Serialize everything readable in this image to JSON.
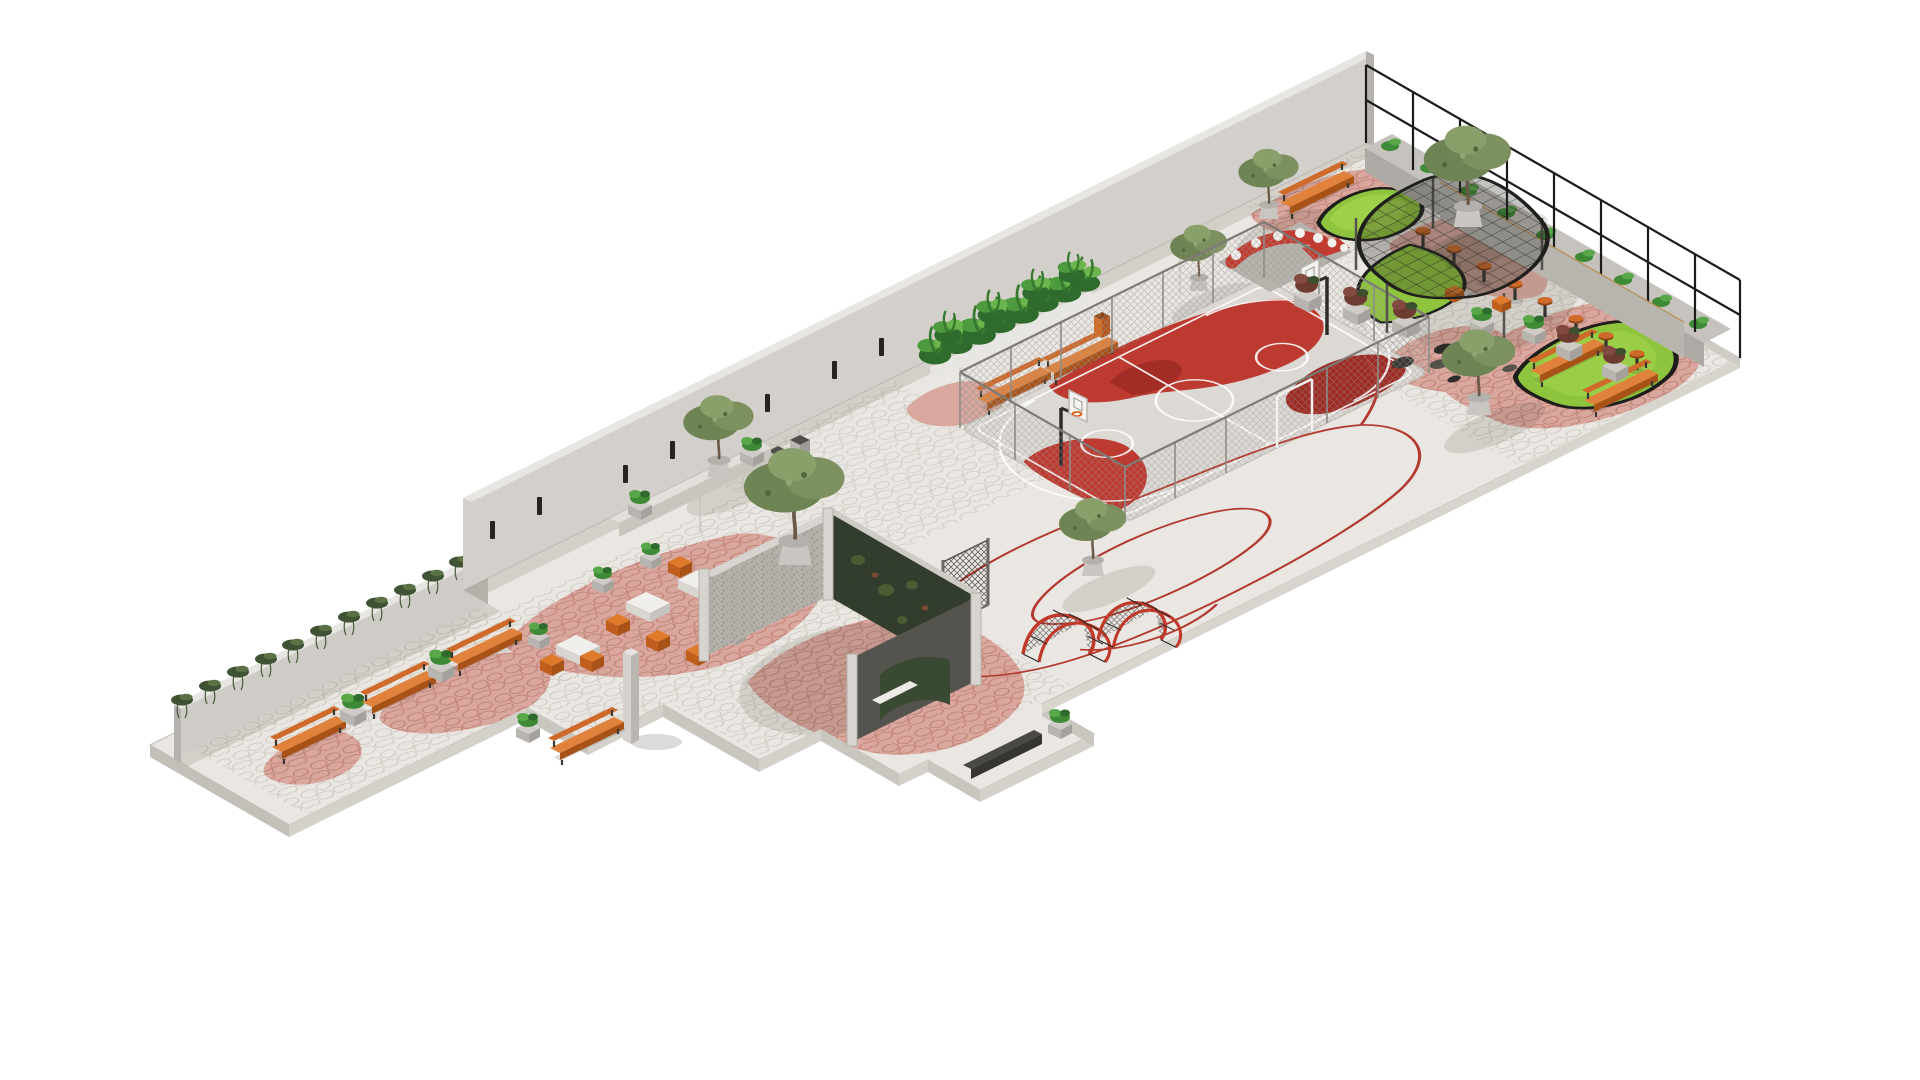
{
  "scene": {
    "kind": "isometric architectural rendering",
    "subject": "linear pocket park / schoolyard landscape design",
    "background": "#ffffff",
    "view": "axonometric from south-west, long site strip running lower-left to upper-right"
  },
  "palette": {
    "background": "#ffffff",
    "paving": "#eae7e2",
    "paving_edge": "#c6c3bd",
    "cobble_line": "#c9c5bd",
    "pink_paving": "#d9a79e",
    "pink_cobble_line": "#b9786d",
    "wall_concrete": "#d3d0cb",
    "wall_concrete_low": "#cfccc7",
    "wall_dark_side": "#b5b2ad",
    "wall_cap": "#e8e6e2",
    "window_slot": "#25241f",
    "court_base": "#dcd9d4",
    "court_red": "#bd3a31",
    "court_red_dark": "#9e2b24",
    "court_line": "#ffffff",
    "lawn_green": "#8fc43e",
    "lawn_light": "#a4d54f",
    "lawn_edge": "#1d1d1b",
    "canopy_fill": "rgba(38,38,33,0.28)",
    "canopy_edge": "#1f1f1d",
    "mesh_grey": "#9b9894",
    "fence_black": "#1b1b1b",
    "wood_orange": "#cf6a2a",
    "wood_orange_dark": "#a85218",
    "wood_counter": "#dcb169",
    "concrete_pot": "#c9c6c1",
    "foliage_olive": "#6f8454",
    "foliage_olive_light": "#8aa06b",
    "foliage_tropical": "#2f6b2c",
    "foliage_tropical_light": "#6ab54e",
    "ivy_green": "#3f5233",
    "shrub_maroon": "#6e3b33",
    "red_line": "#b23a30",
    "play_red": "#c0392b",
    "monolith": "#d5d2cd",
    "gabion": "#b3b0aa",
    "plant_wall": "#333d2e",
    "shadow": "rgba(70,68,60,0.15)"
  },
  "inventory": {
    "structures": [
      "tall perimeter concrete wall with slot openings",
      "low ivy-covered wall at west end",
      "black metal railing fence on north-east edge",
      "U-shaped pavilion with gabion and plant walls",
      "freestanding concrete monolith"
    ],
    "sport": {
      "basketball_courts": 1,
      "basketball_hoops": 2,
      "court_enclosure": "chain-link fence"
    },
    "play": {
      "climbing_mesh_panels": 1,
      "net_climber_tunnels": 2,
      "painted_ground_loops": "red"
    },
    "furniture": {
      "slat_benches": 9,
      "curved_lounge_sofa": 1,
      "bar_counter": 1,
      "bar_stools": 8,
      "orange_seat_cubes": 7,
      "white_tables": 4,
      "wall_ledge_bench": 1,
      "dark_linear_bench": 1
    },
    "planting": {
      "potted_trees": 7,
      "lawn_islands": 3,
      "tropical_planter_hedge": 1,
      "ivy_wall_run": 1,
      "maroon_shrub_planters": 5,
      "small_green_planters": 12,
      "fence_planter_run": 1
    },
    "bins": {
      "grey_bins": 2,
      "orange_bins": 1
    },
    "canopy": {
      "dark_mesh_canopies": 1,
      "canopy_posts": 5
    }
  }
}
